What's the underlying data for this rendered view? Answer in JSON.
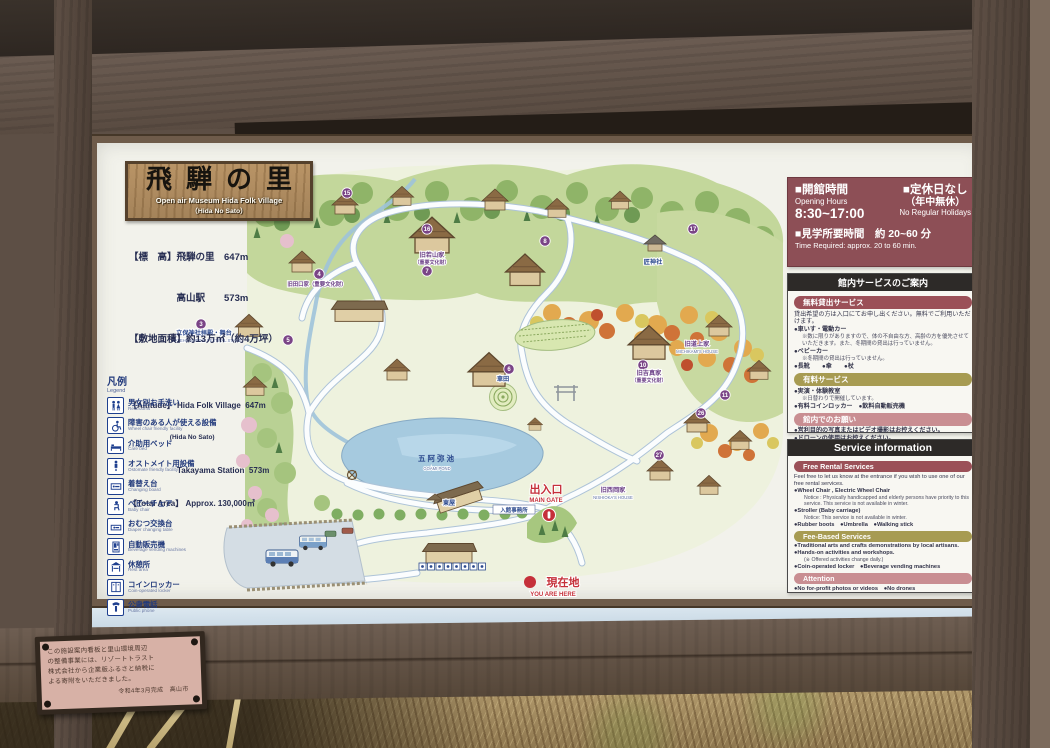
{
  "sign": {
    "title": {
      "ja": "飛騨の里",
      "en": "Open air Museum Hida Folk Village",
      "en2": "（Hida No Sato）"
    },
    "facts": {
      "ja1": "【標　高】飛騨の里　647m",
      "ja2": "　　　　　高山駅　　573m",
      "ja3": "【敷地面積】約13万㎡（約4万坪）",
      "en1": "【Altitude】 Hida Folk Village  647m",
      "en1b": "　　　　　　 (Hida No Sato)",
      "en2": "　　　　　　Takayama Station  573m",
      "en3": "【Total Area】 Approx. 130,000㎡"
    },
    "legend": {
      "title_ja": "凡例",
      "title_en": "Legend",
      "items": [
        {
          "ja": "男女別お手洗い",
          "en": "Restrooms",
          "icon": "restrooms-icon"
        },
        {
          "ja": "障害のある人が使える設備",
          "en": "Wheel chair friendly facility",
          "icon": "wheelchair-icon"
        },
        {
          "ja": "介助用ベッド",
          "en": "Care bed",
          "icon": "care-bed-icon"
        },
        {
          "ja": "オストメイト用設備",
          "en": "Ostomate friendly facility",
          "icon": "ostomate-icon"
        },
        {
          "ja": "着替え台",
          "en": "Changing board",
          "icon": "changing-board-icon"
        },
        {
          "ja": "ベビーチェア",
          "en": "Baby chair",
          "icon": "baby-chair-icon"
        },
        {
          "ja": "おむつ交換台",
          "en": "Diaper changing table",
          "icon": "diaper-table-icon"
        },
        {
          "ja": "自動販売機",
          "en": "Beverage vending machines",
          "icon": "vending-icon"
        },
        {
          "ja": "休憩所",
          "en": "Rest area",
          "icon": "rest-area-icon"
        },
        {
          "ja": "コインロッカー",
          "en": "Coin-operated locker",
          "icon": "locker-icon"
        },
        {
          "ja": "公衆電話",
          "en": "Public phone",
          "icon": "phone-icon"
        }
      ]
    },
    "hours": {
      "open_ja": "■開館時間",
      "open_en": "Opening Hours",
      "open_time": "8:30~17:00",
      "closed_ja": "■定休日なし",
      "closed_ja2": "（年中無休）",
      "closed_en": "No Regular Holidays",
      "dur_ja": "■見学所要時間　約 20~60 分",
      "dur_en": "Time Required: approx. 20 to 60 min."
    },
    "svc_ja": {
      "header": "館内サービスのご案内",
      "free_title": "無料貸出サービス",
      "free_lines": [
        {
          "t": "貸出希望の方は入口にてお申し出ください。無料でご利用いただけます。",
          "c": "plain"
        },
        {
          "t": "●車いす・電動カー",
          "c": "bullet"
        },
        {
          "t": "※数に限りがありますので、体の不自由な方、高齢の方を優先させていただきます。また、冬期間の貸出は行っていません。",
          "c": "note"
        },
        {
          "t": "●ベビーカー",
          "c": "bullet"
        },
        {
          "t": "※冬期間の貸出は行っていません。",
          "c": "note"
        },
        {
          "t": "●長靴　　●傘　　●杖",
          "c": "bullet"
        }
      ],
      "paid_title": "有料サービス",
      "paid_lines": [
        {
          "t": "●実演・体験教室",
          "c": "bullet"
        },
        {
          "t": "※日替わりで開催しています。",
          "c": "note"
        },
        {
          "t": "●有料コインロッカー　●飲料自動販売機",
          "c": "bullet"
        }
      ],
      "req_title": "館内でのお願い",
      "req_lines": [
        {
          "t": "●営利目的の写真またはビデオ撮影はお控えください。",
          "c": "bullet"
        },
        {
          "t": "●ドローンの使用はお控えください。",
          "c": "bullet"
        }
      ]
    },
    "svc_en": {
      "header": "Service information",
      "free_title": "Free Rental Services",
      "free_lines": [
        {
          "t": "Feel free to let us know at the entrance if you wish to use one of our free rental services.",
          "c": "plain"
        },
        {
          "t": "●Wheel Chair , Electric Wheel Chair",
          "c": "bullet"
        },
        {
          "t": "Notice : Physically handicapped and elderly persons have priority to this service. This service is not available in winter.",
          "c": "note"
        },
        {
          "t": "●Stroller (Baby carriage)",
          "c": "bullet"
        },
        {
          "t": "Notice: This service is not available in winter.",
          "c": "note"
        },
        {
          "t": "●Rubber boots　●Umbrella　●Walking stick",
          "c": "bullet"
        }
      ],
      "fee_title": "Fee-Based Services",
      "fee_lines": [
        {
          "t": "●Traditional arts and crafts demonstrations by local artisans.",
          "c": "bullet"
        },
        {
          "t": "●Hands-on activities and workshops.",
          "c": "bullet"
        },
        {
          "t": "(※ Offered activities change daily.)",
          "c": "note"
        },
        {
          "t": "●Coin-operated locker　●Beverage vending machines",
          "c": "bullet"
        }
      ],
      "att_title": "Attention",
      "att_lines": [
        {
          "t": "●No for-profit photos or videos　●No drones",
          "c": "bullet"
        }
      ]
    },
    "map": {
      "marker_color": "#7a4486",
      "markers": [
        {
          "n": "3",
          "x": 104,
          "y": 181
        },
        {
          "n": "4",
          "x": 222,
          "y": 131
        },
        {
          "n": "5",
          "x": 191,
          "y": 197
        },
        {
          "n": "6",
          "x": 412,
          "y": 226
        },
        {
          "n": "7",
          "x": 330,
          "y": 128
        },
        {
          "n": "8",
          "x": 448,
          "y": 98
        },
        {
          "n": "10",
          "x": 546,
          "y": 222
        },
        {
          "n": "11",
          "x": 628,
          "y": 252
        },
        {
          "n": "15",
          "x": 250,
          "y": 50
        },
        {
          "n": "16",
          "x": 330,
          "y": 86
        },
        {
          "n": "17",
          "x": 596,
          "y": 86
        },
        {
          "n": "26",
          "x": 604,
          "y": 270
        },
        {
          "n": "27",
          "x": 562,
          "y": 312
        }
      ],
      "labels": {
        "pond_ja": "五阿弥池",
        "pond_en": "GOAMI POND",
        "gate_ja": "出入口",
        "gate_en": "MAIN GATE",
        "office": "入館事務所",
        "here_ja": "現在地",
        "here_en": "YOU ARE HERE",
        "stage_ja": "立保神社拝殿・舞台",
        "stage_en": "TATEHO SHRINE FESTIVAL STAGE",
        "wakayama_ja": "旧若山家",
        "wakayama_sub": "（重要文化財）",
        "taguchi_ja": "旧田口家（重要文化財）",
        "yoshizane_ja": "旧吉真家",
        "yoshizane_sub": "（重要文化財）",
        "michikami_ja": "旧道上家",
        "michikami_en": "MICHIKAMI'S HOUSE",
        "nishioka_ja": "旧西岡家",
        "nishioka_en": "NISHIOKA'S HOUSE",
        "takumi_ja": "匠神社",
        "kurumada": "車田",
        "azumaya": "東屋"
      }
    }
  },
  "plaque": {
    "lines": [
      {
        "t": "この施設案内看板と里山環境周辺",
        "c": ""
      },
      {
        "t": "の整備事業には、リゾートトラスト",
        "c": ""
      },
      {
        "t": "株式会社から企業版ふるさと納税に",
        "c": ""
      },
      {
        "t": "よる寄附をいただきました。",
        "c": ""
      },
      {
        "t": "令和4年3月完成　高山市",
        "c": "pl-sign"
      }
    ]
  }
}
